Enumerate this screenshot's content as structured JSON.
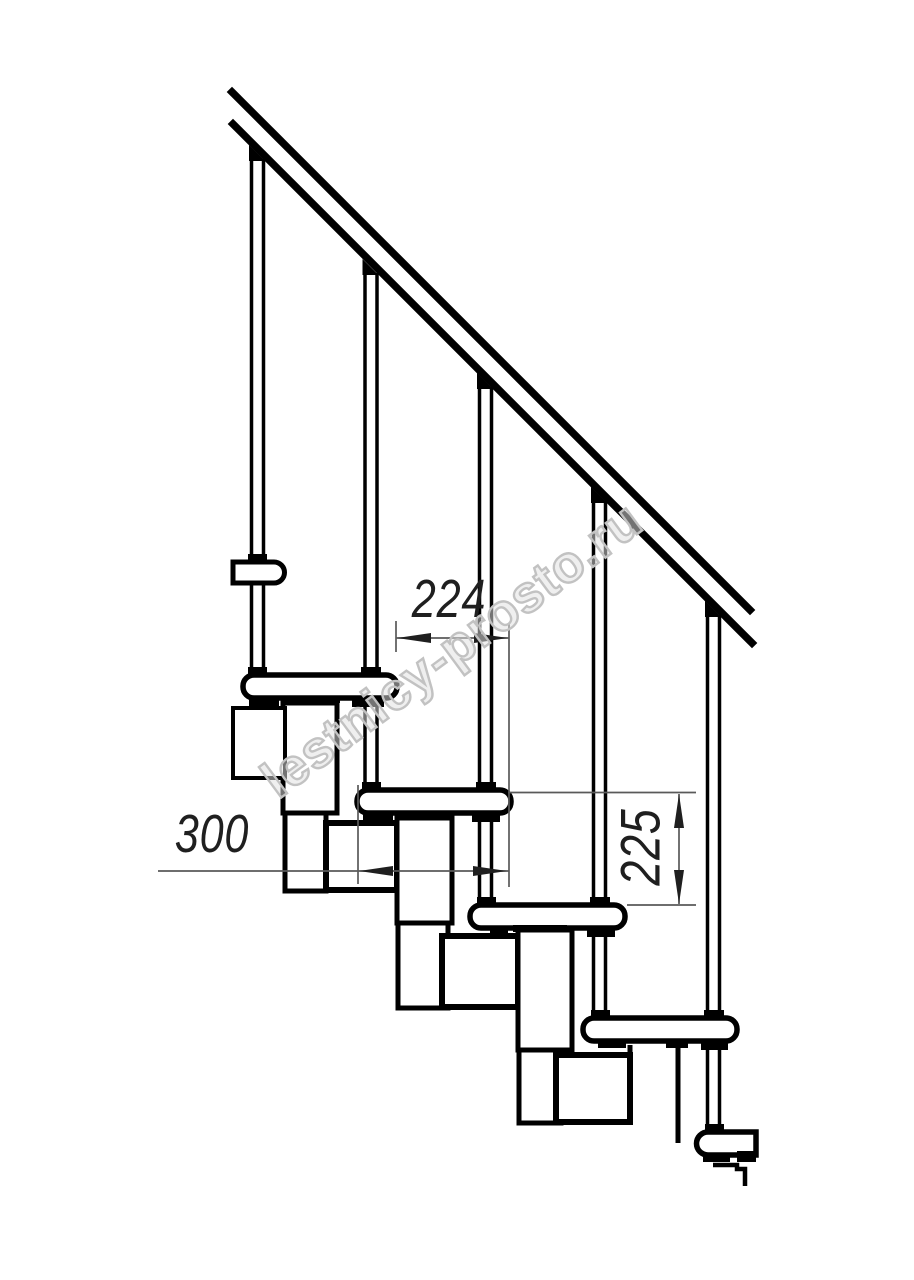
{
  "watermark": {
    "text": "lestnicy-prosto.ru"
  },
  "dimensions": {
    "run_224": {
      "value": "224",
      "orientation": "horizontal"
    },
    "run_300": {
      "value": "300",
      "orientation": "horizontal"
    },
    "rise_225": {
      "value": "225",
      "orientation": "vertical"
    }
  },
  "colors": {
    "background": "#ffffff",
    "ink": "#000000",
    "dim": "#1f1f1f",
    "thin": "#5a5a5a",
    "watermark": "#c2c2c2"
  }
}
